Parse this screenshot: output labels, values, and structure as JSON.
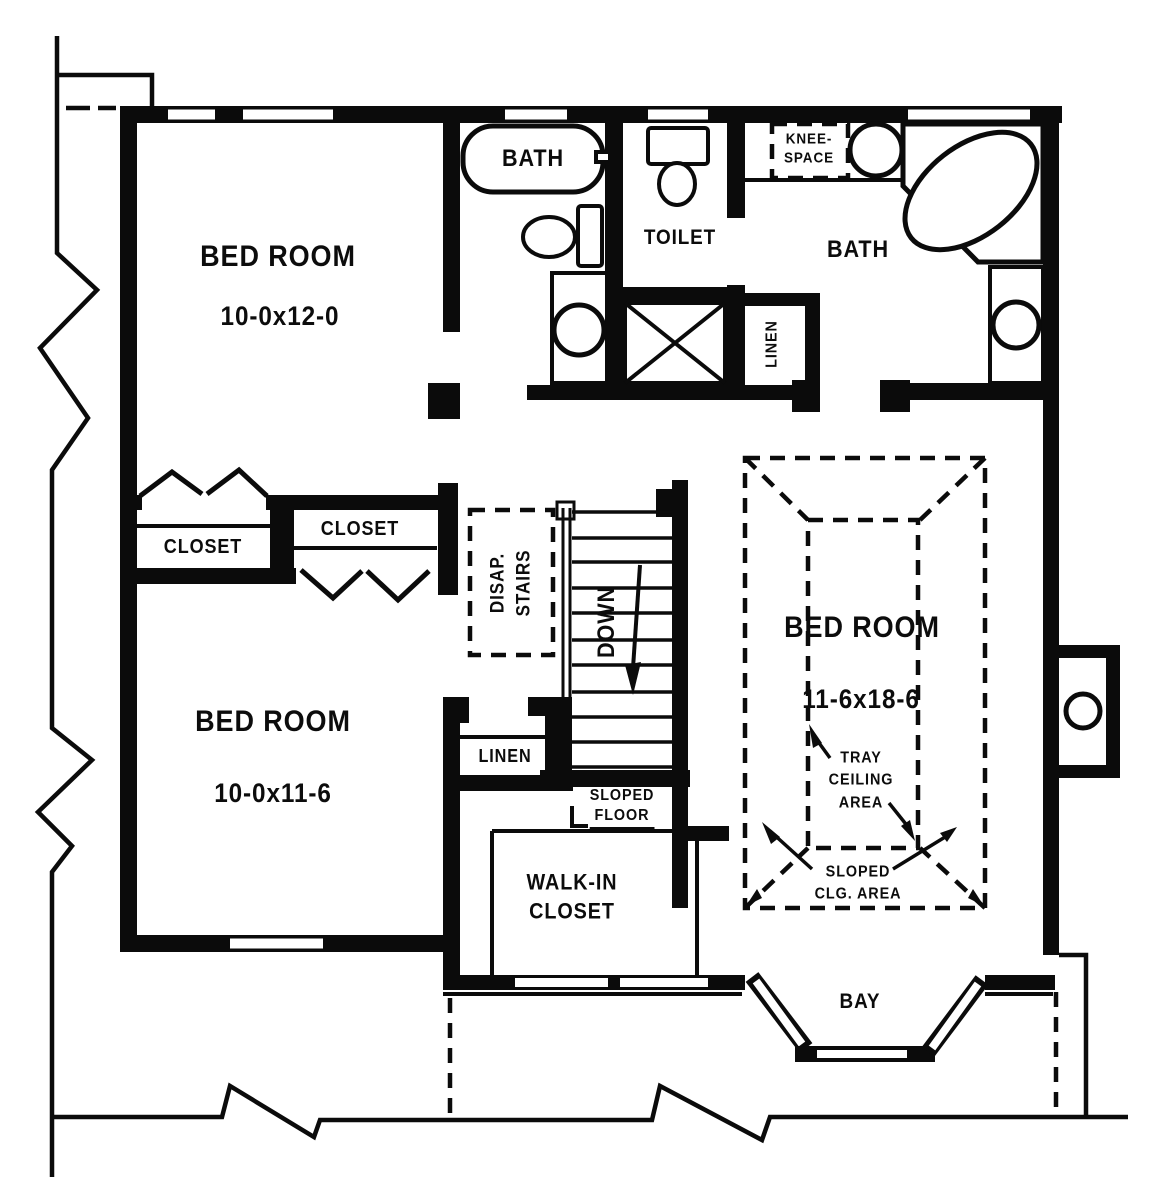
{
  "colors": {
    "ink": "#0b0b0b",
    "paper": "#ffffff"
  },
  "labels": {
    "bedroom_top_left": {
      "name": "BED ROOM",
      "dims": "10-0x12-0"
    },
    "bedroom_bottom_left": {
      "name": "BED ROOM",
      "dims": "10-0x11-6"
    },
    "bedroom_right": {
      "name": "BED ROOM",
      "dims": "11-6x18-6"
    },
    "bath_tub": "BATH",
    "toilet_room": "TOILET",
    "master_bath": "BATH",
    "knee_space": {
      "line1": "KNEE-",
      "line2": "SPACE"
    },
    "closet_left": "CLOSET",
    "closet_right": "CLOSET",
    "disap_stairs": {
      "line1": "DISAP.",
      "line2": "STAIRS"
    },
    "stairs_down": "DOWN",
    "linen_master": "LINEN",
    "linen_hall": "LINEN",
    "sloped_floor": {
      "line1": "SLOPED",
      "line2": "FLOOR"
    },
    "walk_in_closet": {
      "line1": "WALK-IN",
      "line2": "CLOSET"
    },
    "tray_ceiling": {
      "line1": "TRAY",
      "line2": "CEILING",
      "line3": "AREA"
    },
    "sloped_ceiling": {
      "line1": "SLOPED",
      "line2": "CLG. AREA"
    },
    "bay": "BAY"
  }
}
